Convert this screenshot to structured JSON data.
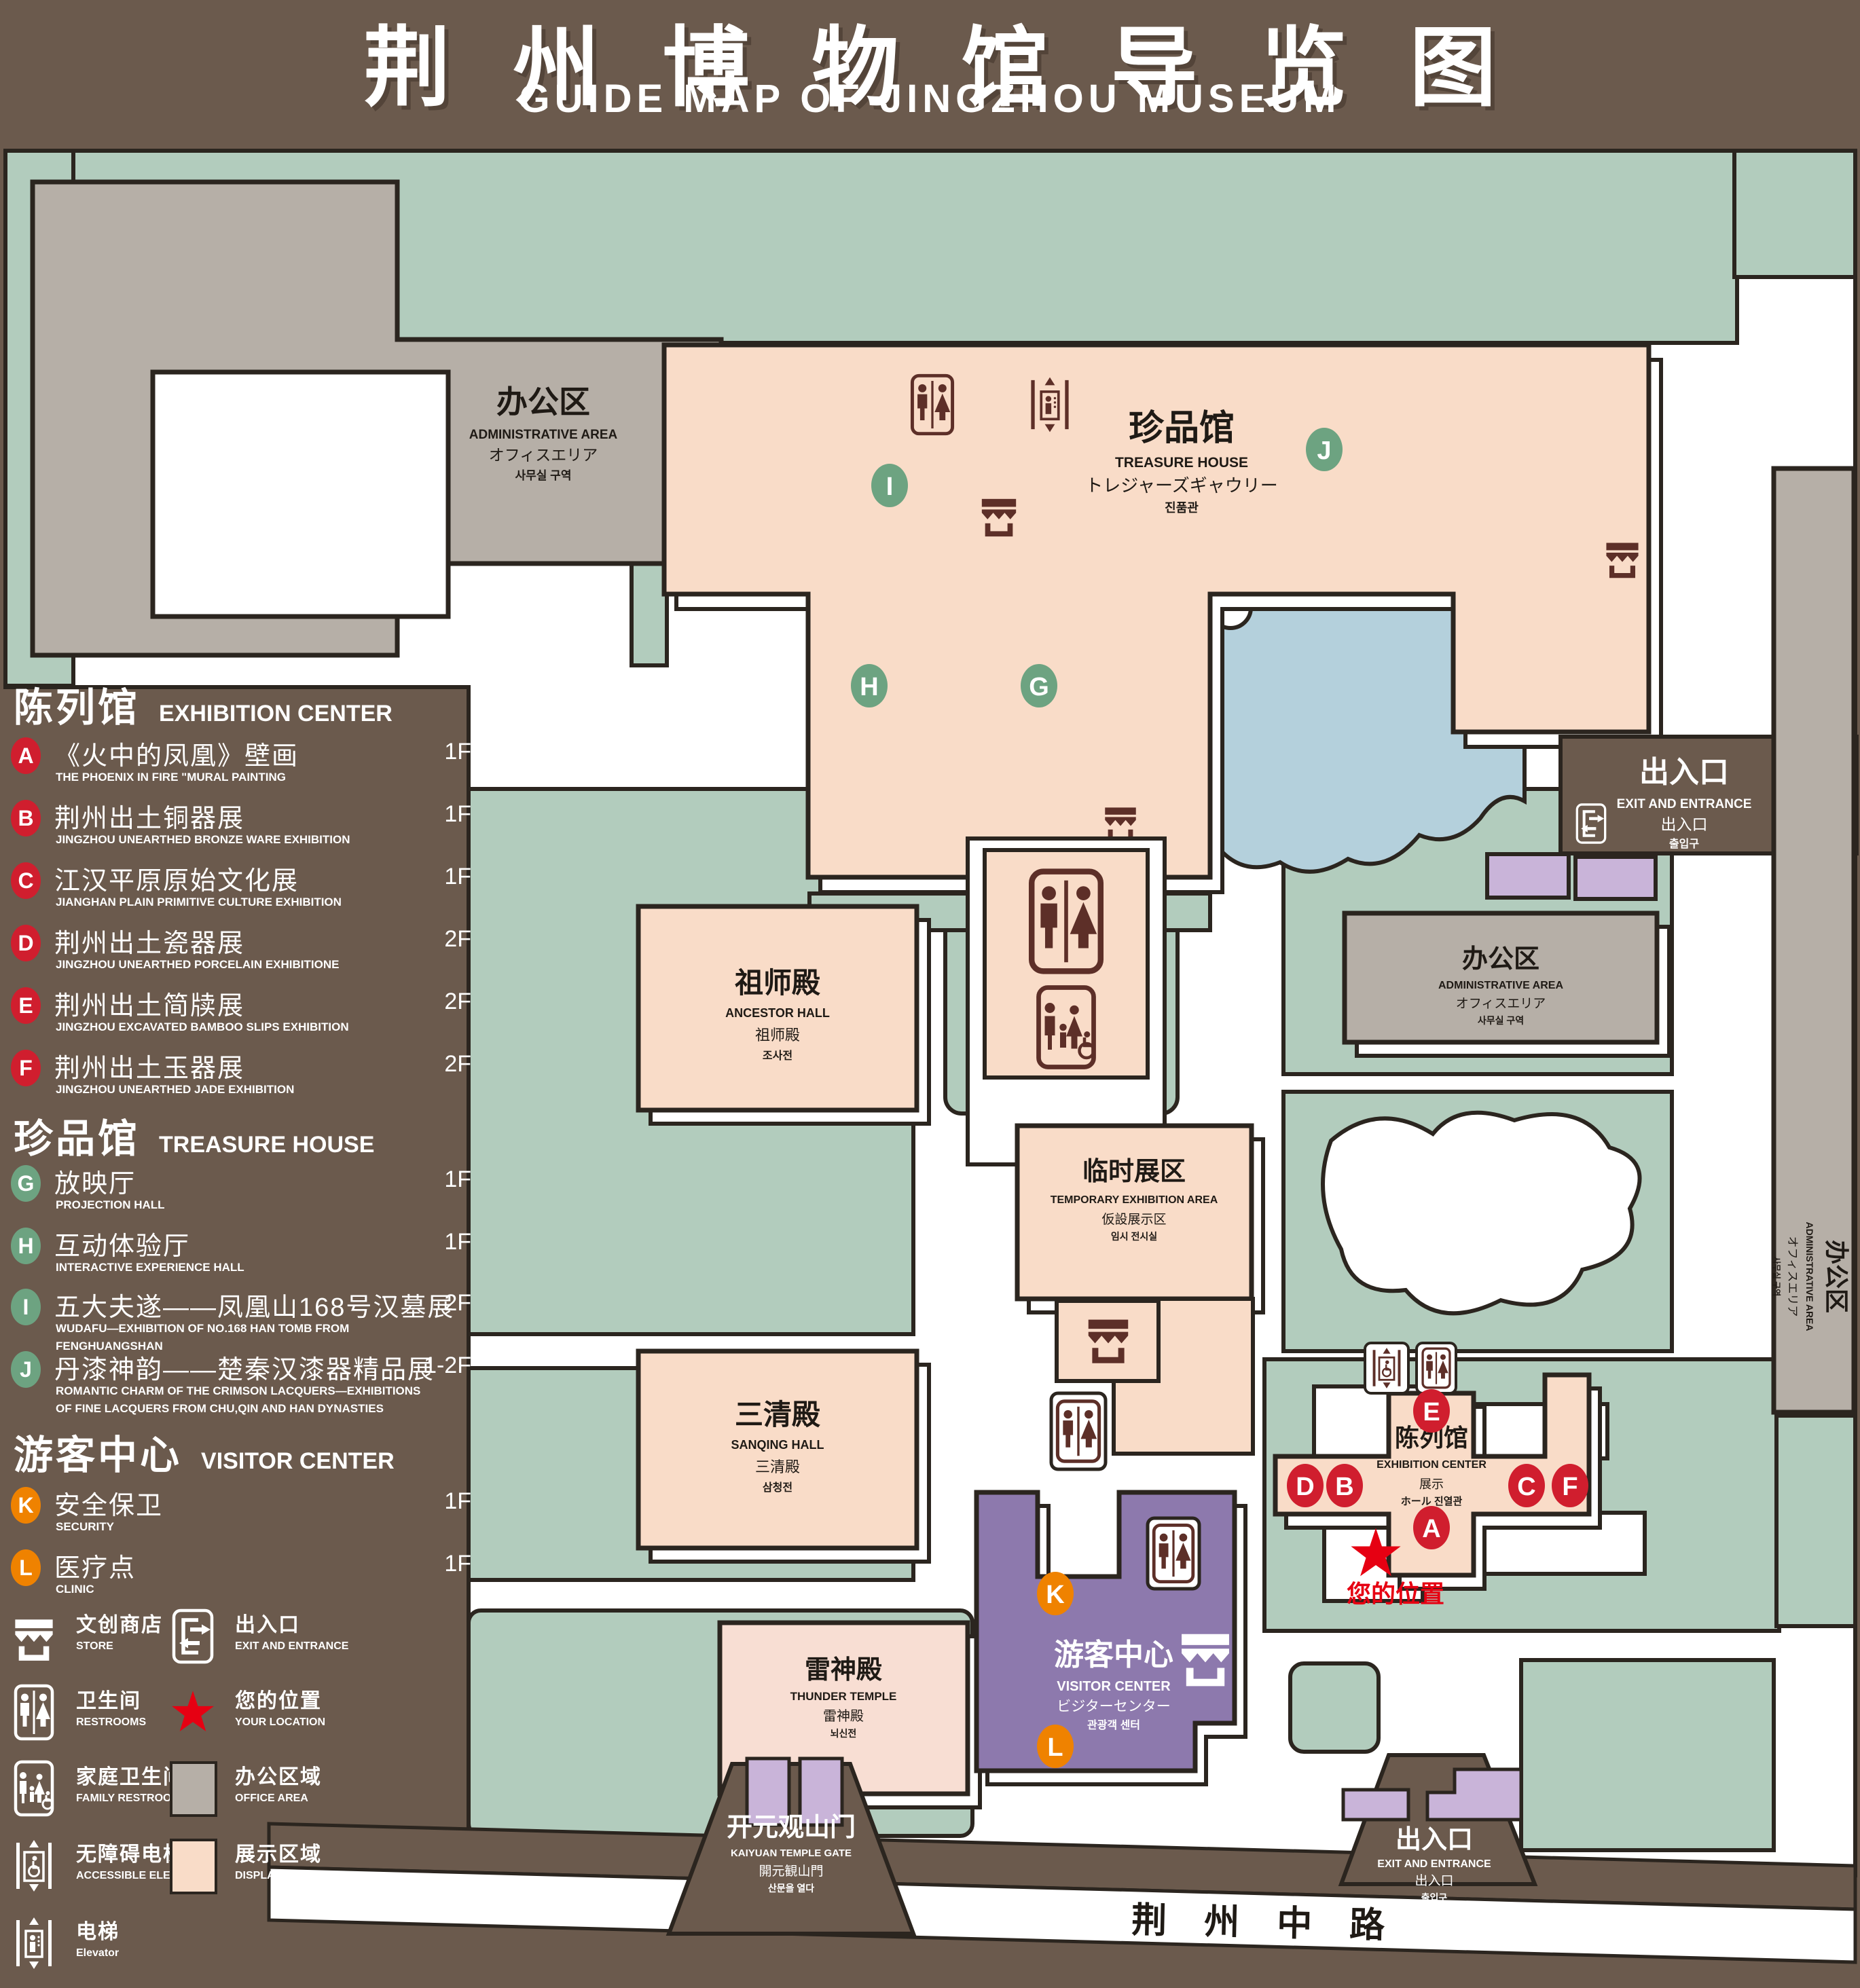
{
  "title": {
    "zh": "荆州博物馆导览图",
    "en": "GUIDE MAP OF JINGZHOU MUSEUM"
  },
  "colors": {
    "background": "#6b5a4d",
    "lawn": "#b2ccbd",
    "display_area": "#f9dcc8",
    "office_area": "#b6afa7",
    "lake": "#b4d0dc",
    "visitor_purple": "#8d79ad",
    "exit_purple": "#c9b4d9",
    "outline": "#2b251f",
    "icon_brown": "#5d2f28",
    "marker_red": "#d01e2e",
    "marker_green": "#6da381",
    "marker_orange": "#ef8200",
    "location_red": "#e60012"
  },
  "legend": {
    "sections": [
      {
        "title_zh": "陈列馆",
        "title_en": "EXHIBITION CENTER",
        "items": [
          {
            "letter": "A",
            "zh": "《火中的凤凰》壁画",
            "en": "THE PHOENIX IN FIRE \"MURAL PAINTING",
            "floor": "1F"
          },
          {
            "letter": "B",
            "zh": "荆州出土铜器展",
            "en": "JINGZHOU UNEARTHED BRONZE WARE EXHIBITION",
            "floor": "1F"
          },
          {
            "letter": "C",
            "zh": "江汉平原原始文化展",
            "en": "JIANGHAN PLAIN PRIMITIVE CULTURE EXHIBITION",
            "floor": "1F"
          },
          {
            "letter": "D",
            "zh": "荆州出土瓷器展",
            "en": "JINGZHOU UNEARTHED PORCELAIN EXHIBITIONE",
            "floor": "2F"
          },
          {
            "letter": "E",
            "zh": "荆州出土简牍展",
            "en": "JINGZHOU EXCAVATED BAMBOO SLIPS EXHIBITION",
            "floor": "2F"
          },
          {
            "letter": "F",
            "zh": "荆州出土玉器展",
            "en": "JINGZHOU UNEARTHED JADE EXHIBITION",
            "floor": "2F"
          }
        ]
      },
      {
        "title_zh": "珍品馆",
        "title_en": "TREASURE HOUSE",
        "items": [
          {
            "letter": "G",
            "zh": "放映厅",
            "en": "PROJECTION HALL",
            "floor": "1F"
          },
          {
            "letter": "H",
            "zh": "互动体验厅",
            "en": "INTERACTIVE EXPERIENCE HALL",
            "floor": "1F"
          },
          {
            "letter": "I",
            "zh": "五大夫遂——凤凰山168号汉墓展",
            "en": "WUDAFU—EXHIBITION OF NO.168 HAN TOMB FROM FENGHUANGSHAN",
            "floor": "2F"
          },
          {
            "letter": "J",
            "zh": "丹漆神韵——楚秦汉漆器精品展",
            "en": "ROMANTIC CHARM OF THE CRIMSON LACQUERS—EXHIBITIONS OF FINE LACQUERS FROM CHU,QIN AND HAN DYNASTIES",
            "floor": "1-2F"
          }
        ]
      },
      {
        "title_zh": "游客中心",
        "title_en": "VISITOR CENTER",
        "items": [
          {
            "letter": "K",
            "zh": "安全保卫",
            "en": "SECURITY",
            "floor": "1F"
          },
          {
            "letter": "L",
            "zh": "医疗点",
            "en": "CLINIC",
            "floor": "1F"
          }
        ]
      }
    ],
    "symbols": [
      {
        "icon": "store-icon",
        "zh": "文创商店",
        "en": "STORE"
      },
      {
        "icon": "exit-icon",
        "zh": "出入口",
        "en": "EXIT AND ENTRANCE"
      },
      {
        "icon": "restroom-icon",
        "zh": "卫生间",
        "en": "RESTROOMS"
      },
      {
        "icon": "your-location-star-icon",
        "zh": "您的位置",
        "en": "YOUR LOCATION"
      },
      {
        "icon": "family-restroom-icon",
        "zh": "家庭卫生间",
        "en": "FAMILY RESTROOMS"
      },
      {
        "icon": "office-area-swatch",
        "zh": "办公区域",
        "en": "OFFICE AREA"
      },
      {
        "icon": "accessible-elevator-icon",
        "zh": "无障碍电梯",
        "en": "ACCESSIBLE ELEVATOR"
      },
      {
        "icon": "display-area-swatch",
        "zh": "展示区域",
        "en": "DISPLAY AREA"
      },
      {
        "icon": "elevator-icon",
        "zh": "电梯",
        "en": "Elevator"
      }
    ]
  },
  "map": {
    "buildings": {
      "admin": {
        "zh": "办公区",
        "en": "ADMINISTRATIVE AREA",
        "ja": "オフィスエリア",
        "ko": "사무실 구역"
      },
      "treasure": {
        "zh": "珍品馆",
        "en": "TREASURE HOUSE",
        "ja": "トレジャーズギャウリー",
        "ko": "진품관"
      },
      "ancestor": {
        "zh": "祖师殿",
        "en": "ANCESTOR HALL",
        "ja": "祖师殿",
        "ko": "조사전"
      },
      "temp": {
        "zh": "临时展区",
        "en": "TEMPORARY EXHIBITION AREA",
        "ja": "仮設展示区",
        "ko": "임시 전시실"
      },
      "sanqing": {
        "zh": "三清殿",
        "en": "SANQING HALL",
        "ja": "三清殿",
        "ko": "삼청전"
      },
      "thunder": {
        "zh": "雷神殿",
        "en": "THUNDER TEMPLE",
        "ja": "雷神殿",
        "ko": "뇌신전"
      },
      "visitor": {
        "zh": "游客中心",
        "en": "VISITOR CENTER",
        "ja": "ビジターセンター",
        "ko": "관광객 센터"
      },
      "exhibition": {
        "zh": "陈列馆",
        "en": "EXHIBITION CENTER",
        "ja": "展示",
        "ko": "ホール 진열관"
      },
      "gate": {
        "zh": "开元观山门",
        "en": "KAIYUAN TEMPLE GATE",
        "ja": "開元観山門",
        "ko": "산문을 열다"
      },
      "exit": {
        "zh": "出入口",
        "en": "EXIT AND ENTRANCE",
        "ja": "出入口",
        "ko": "출입구"
      },
      "road": {
        "zh": "荆州中路"
      }
    },
    "your_location": "您的位置",
    "markers": [
      {
        "letter": "A"
      },
      {
        "letter": "B"
      },
      {
        "letter": "C"
      },
      {
        "letter": "D"
      },
      {
        "letter": "E"
      },
      {
        "letter": "F"
      },
      {
        "letter": "G"
      },
      {
        "letter": "H"
      },
      {
        "letter": "I"
      },
      {
        "letter": "J"
      },
      {
        "letter": "K"
      },
      {
        "letter": "L"
      }
    ]
  }
}
